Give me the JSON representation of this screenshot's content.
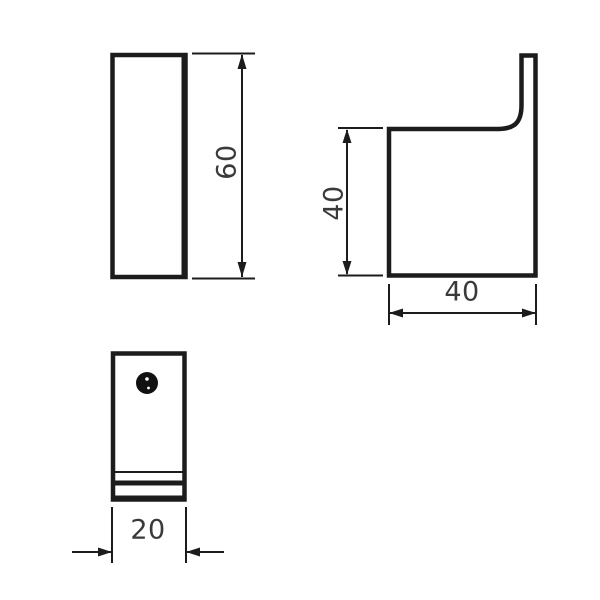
{
  "drawing": {
    "background_color": "#ffffff",
    "line_color": "#1c1c1c",
    "text_color": "#3a3a3a",
    "dimensions": {
      "front_height": "60",
      "side_height": "40",
      "side_depth": "40",
      "bottom_width": "20"
    }
  }
}
